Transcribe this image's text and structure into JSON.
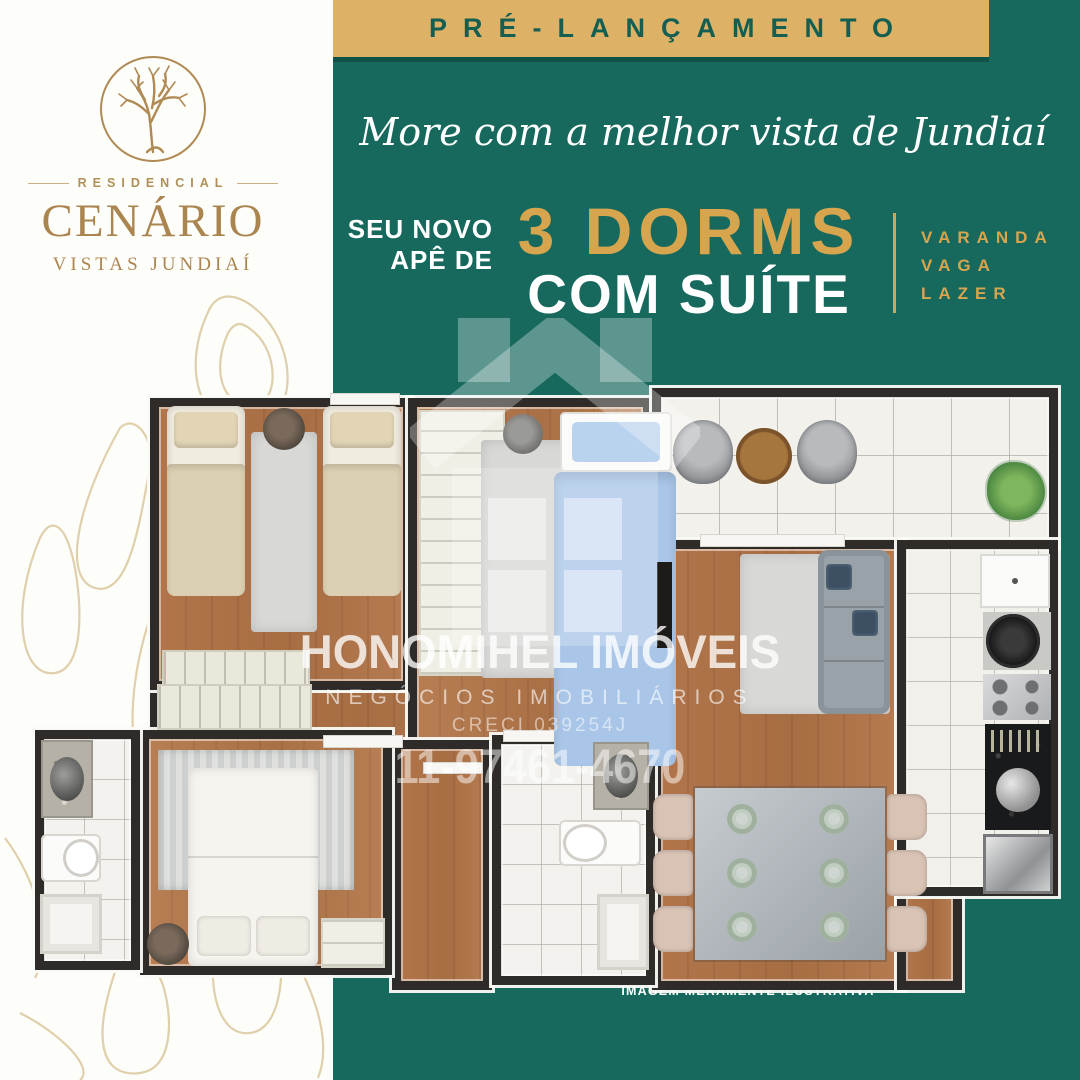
{
  "colors": {
    "teal": "#17695d",
    "banner_gold": "#ddb266",
    "accent_gold": "#d7a54e",
    "logo_gold": "#ad8752",
    "wall": "#2f2b28"
  },
  "logo": {
    "category": "RESIDENCIAL",
    "name": "CENÁRIO",
    "location": "VISTAS JUNDIAÍ",
    "icon": "tree-in-circle-icon"
  },
  "banner": {
    "label": "PRÉ-LANÇAMENTO"
  },
  "headline": {
    "text": "More com a melhor vista de Jundiaí"
  },
  "offer": {
    "prefix_line1": "SEU NOVO",
    "prefix_line2": "APÊ DE",
    "dorms": "3 DORMS",
    "suite": "COM SUÍTE",
    "perks": [
      "VARANDA",
      "VAGA",
      "LAZER"
    ]
  },
  "watermark": {
    "company": "HONOMIHEL IMÓVEIS",
    "tagline": "NEGÓCIOS IMOBILIÁRIOS",
    "creci": "CRECI 039254J",
    "phone": "11-97461-4670",
    "icon": "house-icon"
  },
  "footnote": {
    "text": "IMAGEM MERAMENTE ILUSTRATIVA"
  }
}
